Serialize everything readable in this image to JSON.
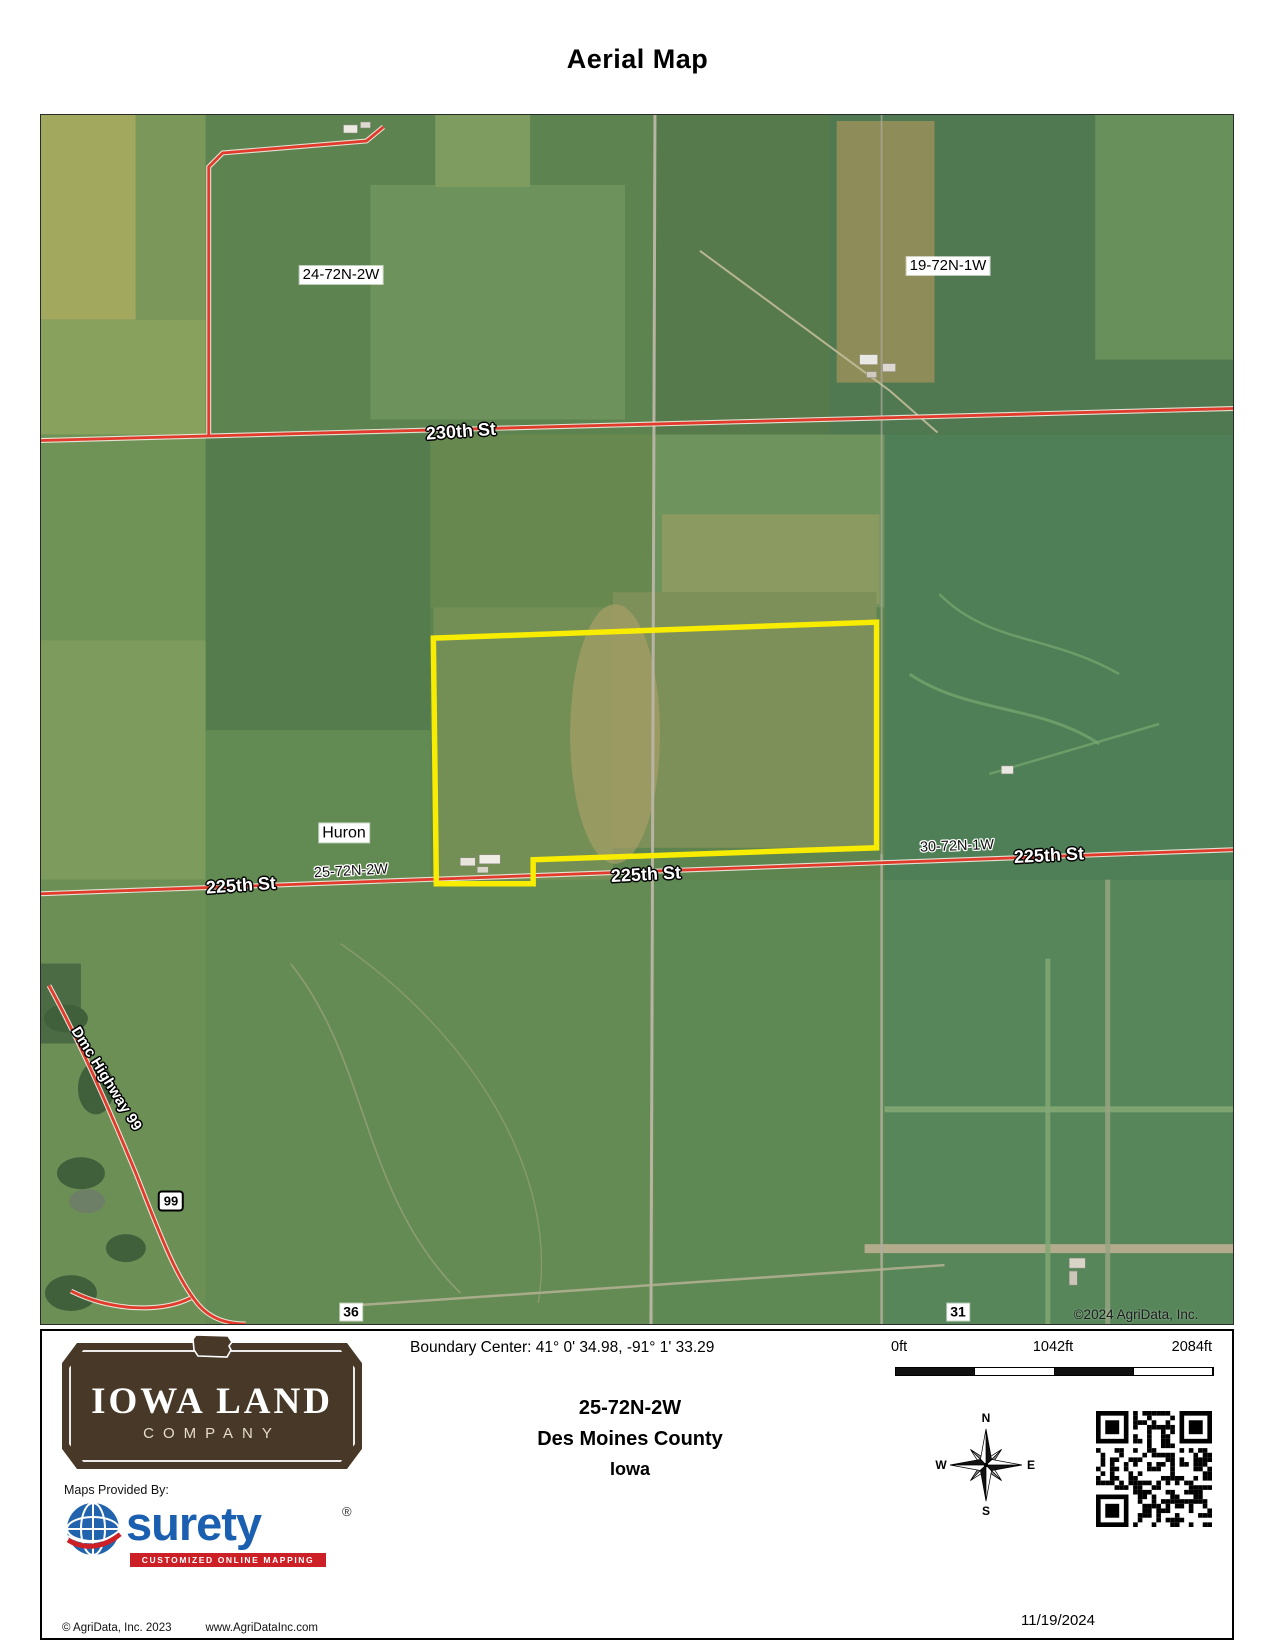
{
  "page": {
    "title": "Aerial Map"
  },
  "map": {
    "labels": {
      "sec24": "24-72N-2W",
      "sec19": "19-72N-1W",
      "road_230": "230th St",
      "huron": "Huron",
      "twp25": "25-72N-2W",
      "road_225_left": "225th St",
      "road_225_mid": "225th St",
      "twp30": "30-72N-1W",
      "road_225_right": "225th St",
      "sec36": "36",
      "sec31": "31",
      "highway99": "Dmc Highway 99",
      "badge99": "99",
      "copyright": "©2024 AgriData, Inc."
    },
    "colors": {
      "boundary": "#f8ec00",
      "highlight_road": "#e23b2c"
    }
  },
  "footer": {
    "boundary_center": "Boundary Center: 41° 0' 34.98,  -91° 1' 33.29",
    "scale": {
      "start": "0ft",
      "mid": "1042ft",
      "end": "2084ft"
    },
    "parcel": {
      "township": "25-72N-2W",
      "county": "Des Moines County",
      "state": "Iowa"
    },
    "compass": {
      "n": "N",
      "e": "E",
      "s": "S",
      "w": "W"
    },
    "date": "11/19/2024",
    "logo": {
      "line1": "IOWA LAND",
      "line2": "COMPANY"
    },
    "provider": {
      "label": "Maps Provided By:",
      "name": "surety",
      "reg": "®",
      "tagline": "CUSTOMIZED ONLINE MAPPING"
    },
    "credits": {
      "left": "© AgriData, Inc. 2023",
      "right": "www.AgriDataInc.com"
    }
  }
}
